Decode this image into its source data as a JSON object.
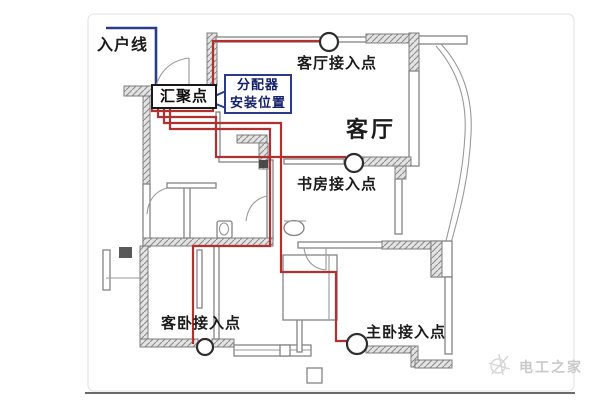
{
  "diagram": {
    "description": "apartment weak-current wiring floor plan",
    "labels": {
      "entry_line": "入户线",
      "hub": "汇聚点",
      "distributor_line1": "分配器",
      "distributor_line2": "安装位置",
      "living_room": "客厅",
      "ap_living": "客厅接入点",
      "ap_study": "书房接入点",
      "ap_guest_bedroom": "客卧接入点",
      "ap_master_bedroom": "主卧接入点"
    },
    "watermark": "电工之家",
    "colors": {
      "cable_red": "#b23030",
      "entry_blue": "#2c3a8c",
      "wall_gray": "#848484",
      "hatch_fill": "#e3e3e3",
      "access_point_ring": "#2e2e2e",
      "watermark_gray": "#c9c9c9"
    }
  }
}
